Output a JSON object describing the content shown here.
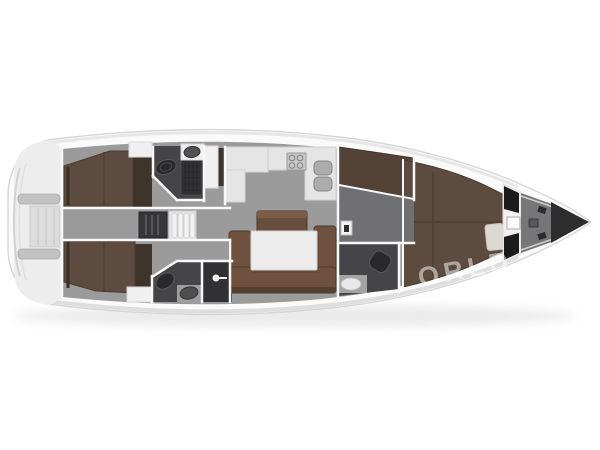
{
  "watermark": {
    "text": "ORLD",
    "color": "#ffffff"
  },
  "palette": {
    "background": "#ffffff",
    "hull": "#fafafa",
    "hull_outline": "#d6d6d6",
    "hull_shade": "#e2e2e2",
    "floor": "#9b9b9b",
    "floor_mid_cabin": "#707073",
    "wall": "#f8f8f8",
    "wood": "#5d4b3f",
    "wood_dark": "#3e342c",
    "wood_mid": "#544236",
    "sofa": "#6e523f",
    "counter": "#e5e5e5",
    "white_furniture": "#f0f0f0",
    "table": "#ececec",
    "bath": "#454548",
    "bath_dark": "#313134",
    "fixture_dark": "#29292b",
    "fixture_gray": "#acacac",
    "black": "#1b1b1b",
    "locker": "#767678",
    "bow_tip": "#2d2d2d",
    "platform": "#ededed",
    "seat_bar": "#c2c2c2"
  }
}
